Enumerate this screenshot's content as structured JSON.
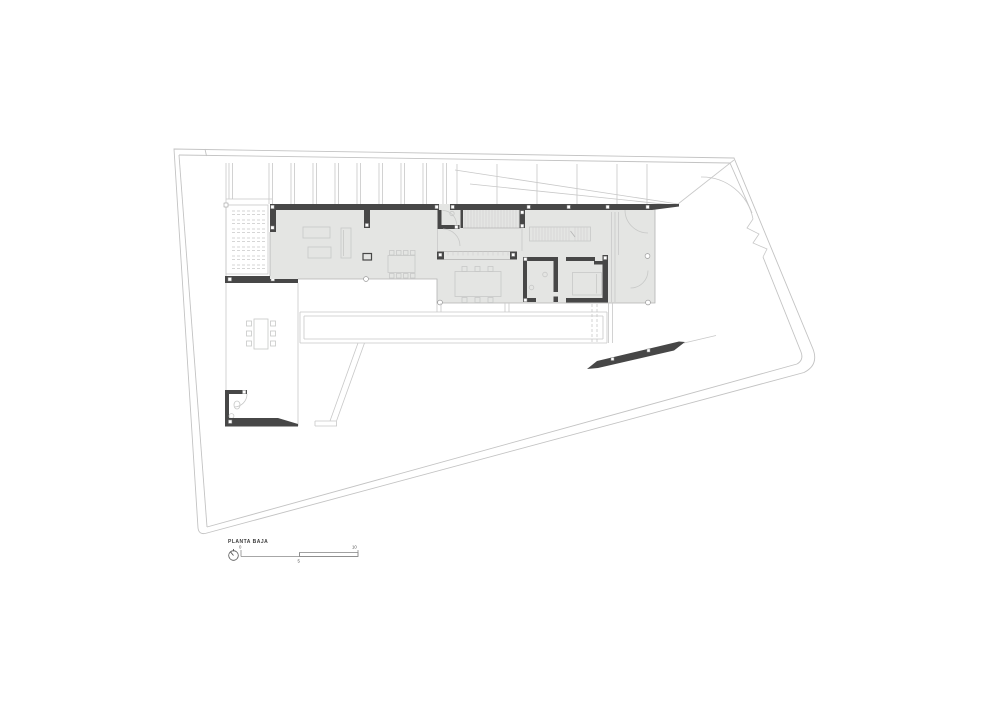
{
  "drawing": {
    "title": "PLANTA BAJA",
    "kind": "architectural floor plan, ground floor"
  },
  "scale_bar": {
    "start_label": "0",
    "mid_label": "5",
    "end_label": "10"
  },
  "icons": {
    "north_arrow": "compass-circle-with-needle"
  },
  "colors": {
    "background": "#ffffff",
    "wall_poche": "#474747",
    "floor_fill": "#e4e5e3",
    "boundary_line": "#c3c3c3",
    "furniture_line": "#c7c8c7",
    "text": "#3a3a3a"
  }
}
